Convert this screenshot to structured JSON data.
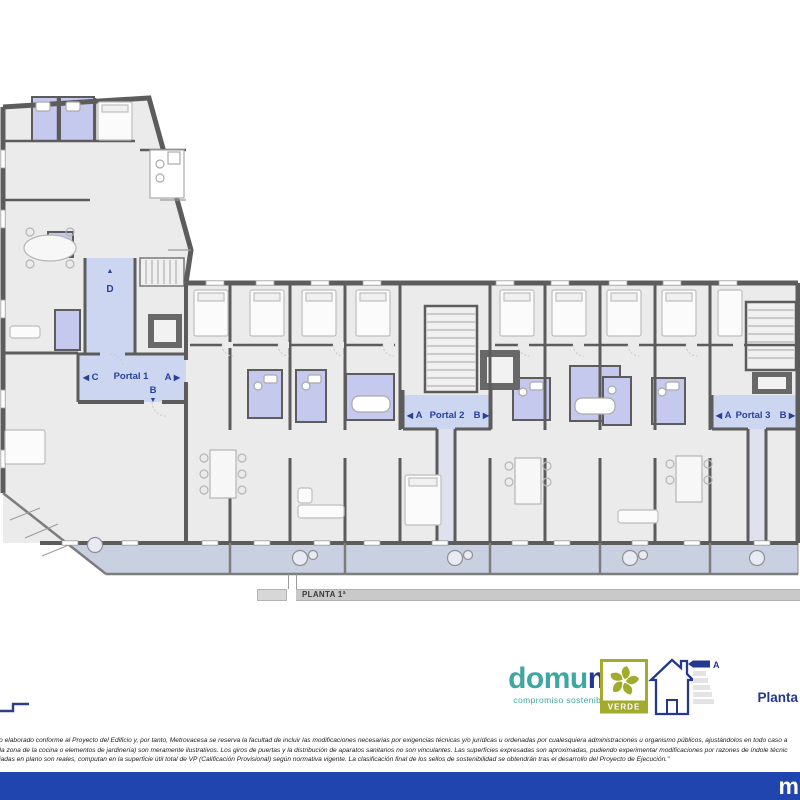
{
  "document": {
    "floor_bar_label": "PLANTA 1ª",
    "page_label": "Planta",
    "footer_brand_mark": "m"
  },
  "plan": {
    "portal1": {
      "name": "Portal 1",
      "exit_left": "C",
      "exit_right": "A",
      "exit_bottom": "B"
    },
    "portal2": {
      "name": "Portal 2",
      "exit_left": "A",
      "exit_right": "B"
    },
    "portal3": {
      "name": "Portal 3",
      "exit_left": "A",
      "exit_right": "B"
    },
    "corridor_exit": "D"
  },
  "icons": {
    "arrow_left": "◀",
    "arrow_right": "▶",
    "arrow_up": "▲",
    "arrow_down": "▼"
  },
  "branding": {
    "logo_word_start": "domu",
    "logo_word_end": "m",
    "tagline": "compromiso sostenible",
    "verde_badge": "VERDE",
    "energy_letter": "A"
  },
  "disclaimer": {
    "line1": "ido elaborado conforme al Proyecto del Edificio y, por tanto, Metrovacesa se reserva la facultad de incluir las modificaciones necesarias por exigencias técnicas y/o jurídicas u ordenadas por cualesquiera administraciones u organismo públicos, ajustándolos en todo caso a",
    "line2": "n la zona de la cocina o elementos de jardinería) son meramente ilustrativos. Los giros de puertas y la distribución de aparatos sanitarios no son vinculantes. Las superficies expresadas son aproximadas, pudiendo experimentar modificaciones por razones de índole técnic",
    "line3": "lejadas en plano son reales, computan en la superficie útil total de VP (Calificación Provisional) según normativa vigente. La clasificación final de los sellos de sostenibilidad se obtendrán tras el desarrollo del Proyecto de Ejecución.\""
  },
  "colors": {
    "wall": "#5c5c5c",
    "floor": "#ebebeb",
    "wet_room": "#c5c9ee",
    "portal": "#ccd6f0",
    "balcony": "#c8d0e2",
    "label_navy": "#27409b",
    "brand_teal": "#3fa6a0",
    "brand_navy": "#24388f",
    "verde_green": "#a3ab2c",
    "footer_blue": "#2145ae",
    "bar_gray": "#c9c9c9"
  }
}
